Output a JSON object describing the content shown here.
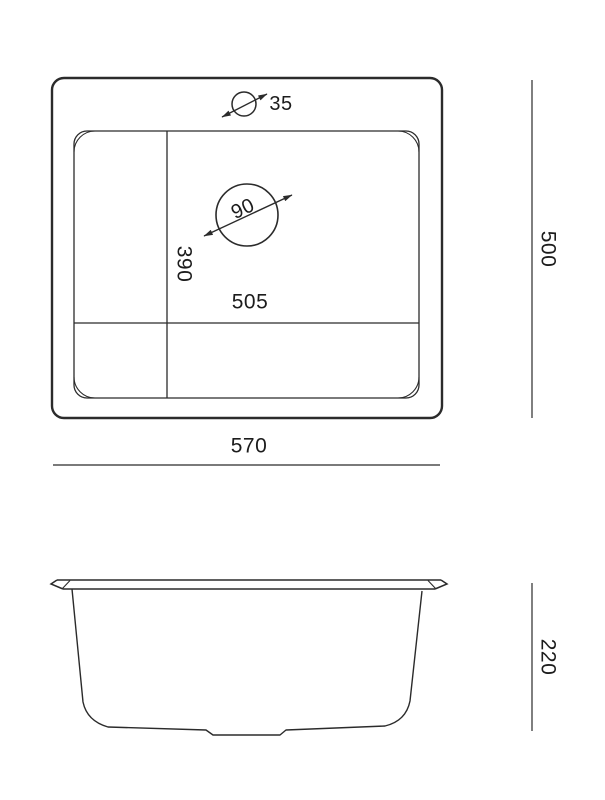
{
  "page": {
    "background": "#ffffff"
  },
  "drawing": {
    "type": "technical-dimension-drawing",
    "subject": "sink",
    "line_color": "#2b2b2b",
    "text_color": "#1c1c1c",
    "views": {
      "top_view": {
        "label": "top-view",
        "dimensions": {
          "faucet_hole_diameter": "35",
          "drain_hole_diameter": "90",
          "bowl_depth": "390",
          "bowl_width": "505",
          "overall_depth": "500",
          "overall_width": "570"
        }
      },
      "side_view": {
        "label": "side-view",
        "dimensions": {
          "overall_height": "220"
        }
      }
    }
  }
}
